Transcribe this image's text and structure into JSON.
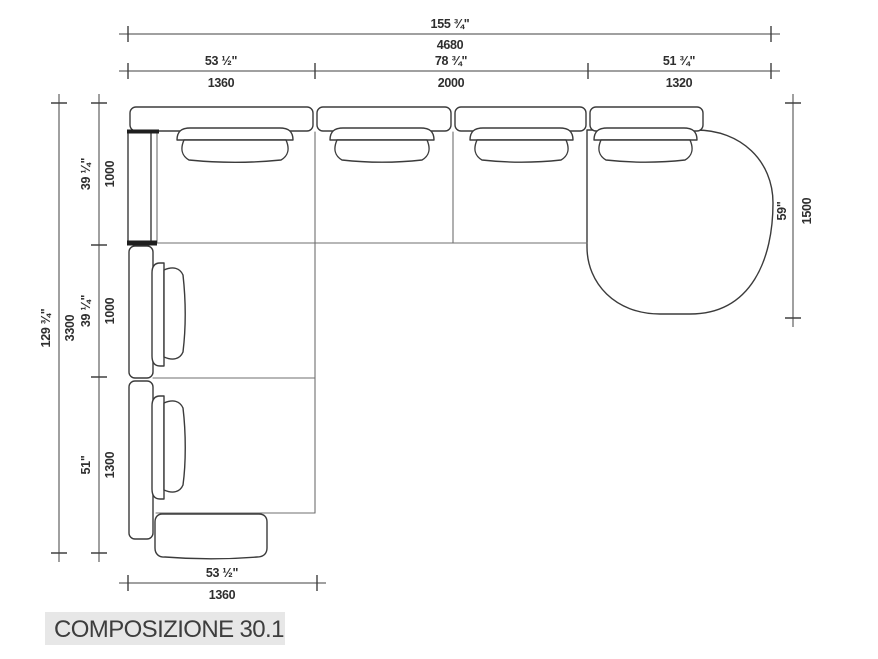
{
  "title": "COMPOSIZIONE 30.1",
  "colors": {
    "background": "#ffffff",
    "line": "#3b3b3b",
    "dimension_text": "#2e2e2e",
    "title_bar_bg": "#e7e7e7"
  },
  "dims": {
    "overall_width": {
      "in": "155 ¾\"",
      "mm": "4680"
    },
    "top_segments": [
      {
        "in": "53 ½\"",
        "mm": "1360"
      },
      {
        "in": "78 ¾\"",
        "mm": "2000"
      },
      {
        "in": "51 ¾\"",
        "mm": "1320"
      }
    ],
    "overall_depth": {
      "in": "129 ¾\"",
      "mm": "3300"
    },
    "left_segments": [
      {
        "in": "39 ¼\"",
        "mm": "1000"
      },
      {
        "in": "39 ¼\"",
        "mm": "1000"
      },
      {
        "in": "51\"",
        "mm": "1300"
      }
    ],
    "right_depth": {
      "in": "59\"",
      "mm": "1500"
    },
    "bottom_width": {
      "in": "53 ½\"",
      "mm": "1360"
    }
  }
}
